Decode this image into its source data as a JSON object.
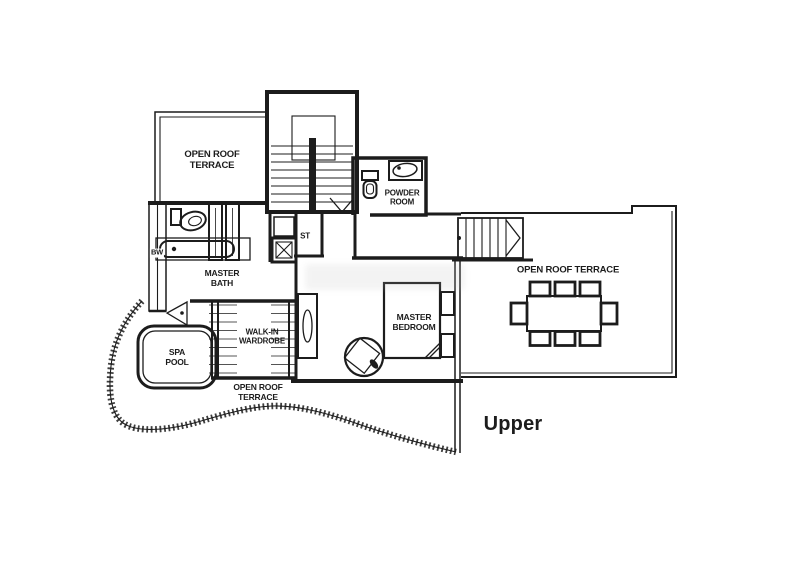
{
  "figure": {
    "type": "floor-plan",
    "floor_label": "Upper",
    "background": "#ffffff",
    "line_color": "#1c1c1c"
  },
  "rooms": {
    "terrace_top_left": {
      "line1": "OPEN ROOF",
      "line2": "TERRACE"
    },
    "powder_room": {
      "line1": "POWDER",
      "line2": "ROOM"
    },
    "store": {
      "label": "ST"
    },
    "bay_window": {
      "label": "BW"
    },
    "master_bath": {
      "line1": "MASTER",
      "line2": "BATH"
    },
    "walk_in_wardrobe": {
      "line1": "WALK-IN",
      "line2": "WARDROBE"
    },
    "spa_pool": {
      "line1": "SPA",
      "line2": "POOL"
    },
    "terrace_lower": {
      "line1": "OPEN ROOF",
      "line2": "TERRACE"
    },
    "master_bedroom": {
      "line1": "MASTER",
      "line2": "BEDROOM"
    },
    "terrace_right": {
      "label": "OPEN ROOF TERRACE"
    }
  }
}
